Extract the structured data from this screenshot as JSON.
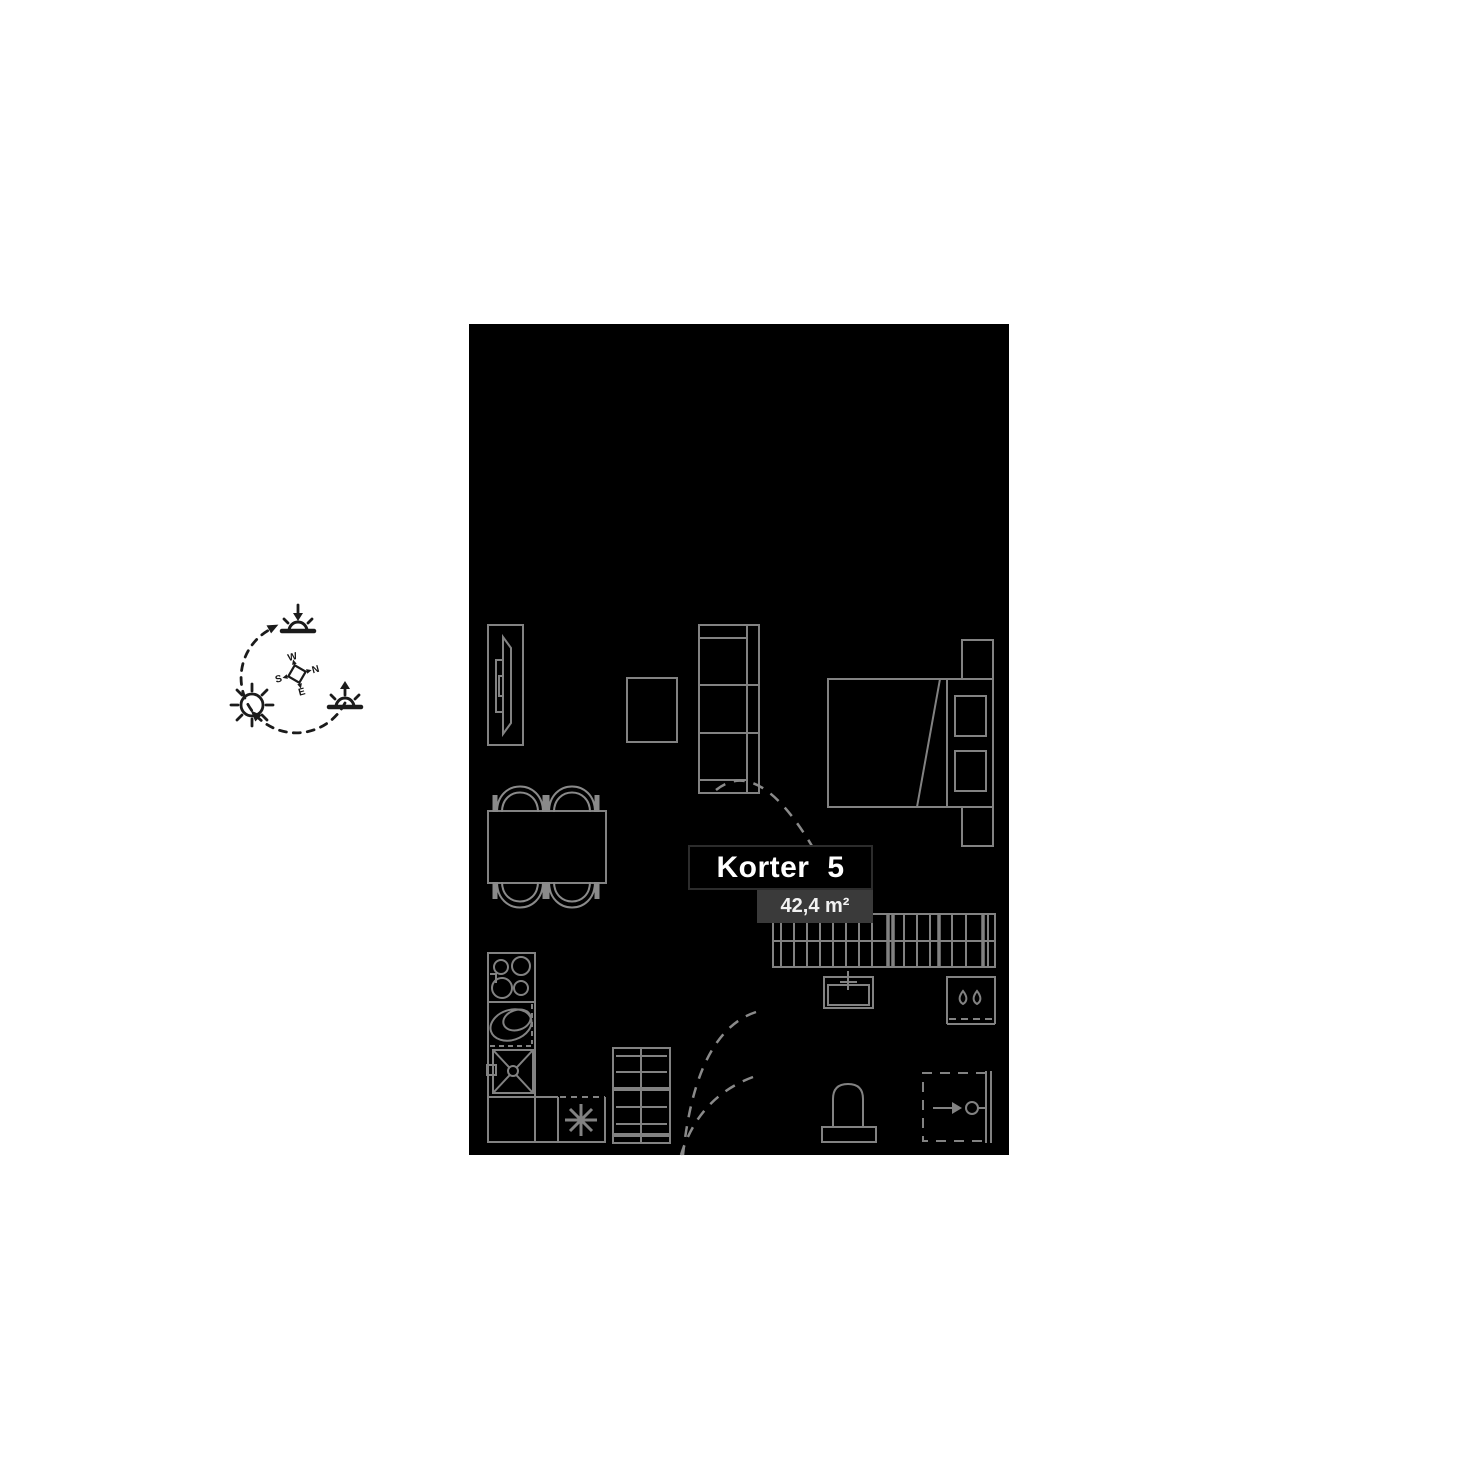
{
  "page": {
    "background_color": "#ffffff"
  },
  "label": {
    "title": "Korter 5",
    "area": "42,4 m²"
  },
  "compass": {
    "north": "N",
    "east": "E",
    "south": "S",
    "west": "W"
  },
  "colors": {
    "plan_background": "#000000",
    "furniture_line": "#828282",
    "door_swing_line": "#8a8a8a",
    "title_box_background": "#000000",
    "title_box_border": "#2c2c2c",
    "title_text": "#ffffff",
    "area_box_background": "#3a3a3a",
    "area_text": "#f2f2f2",
    "sun_diagram_line": "#1b1b1b"
  },
  "sun_diagram_icons": [
    "sunset-icon",
    "sun-icon",
    "sunrise-icon",
    "compass-rose-icon",
    "sun-path-arc"
  ],
  "furniture_symbols": [
    "tv-unit",
    "side-table",
    "sofa",
    "bed-with-nightstands",
    "dining-table-with-chairs",
    "kitchen-hob",
    "kitchen-oval-sink",
    "kitchen-sink",
    "dishwasher",
    "drying-rack",
    "door-swings",
    "wardrobe",
    "bathroom-sink",
    "washing-machine",
    "toilet",
    "shower"
  ]
}
